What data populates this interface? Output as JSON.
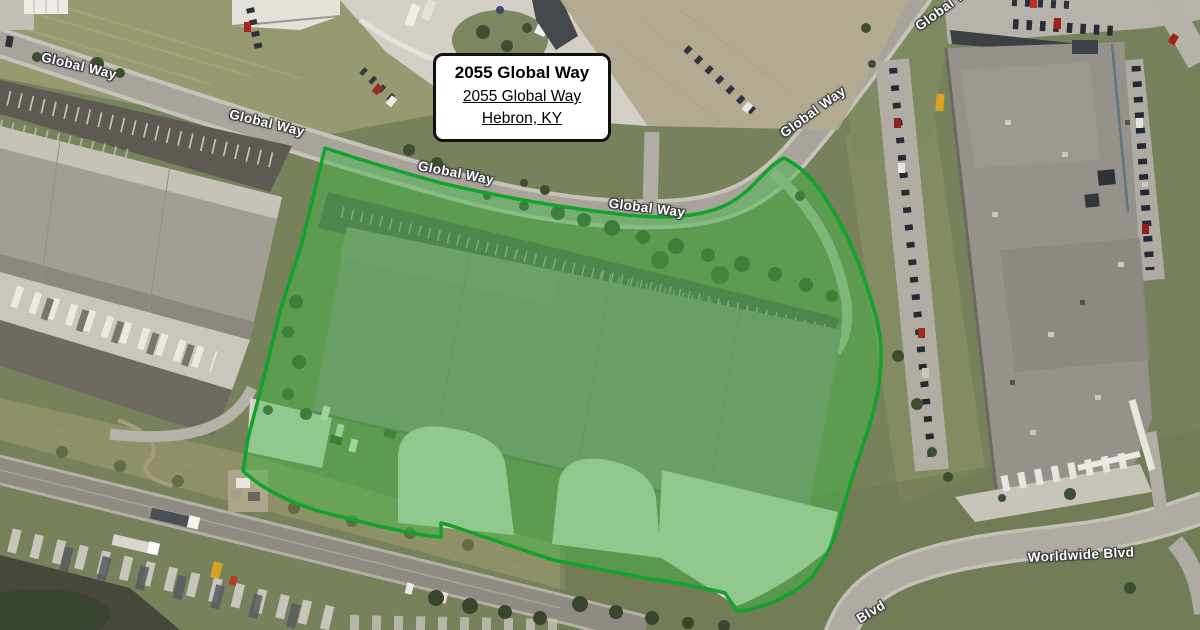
{
  "map_view": {
    "type": "satellite-imagery",
    "info_box": {
      "title": "2055 Global Way",
      "address_line1": "2055 Global Way",
      "address_line2": "Hebron, KY"
    },
    "road_labels": [
      {
        "id": "global-way-1",
        "text": "Global Way"
      },
      {
        "id": "global-way-2",
        "text": "Global Way"
      },
      {
        "id": "global-way-3",
        "text": "Global Way"
      },
      {
        "id": "global-way-4",
        "text": "Global Way"
      },
      {
        "id": "global-way-5",
        "text": "Global Way"
      },
      {
        "id": "global-way-6",
        "text": "Global Way"
      },
      {
        "id": "worldwide-blvd",
        "text": "Worldwide Blvd"
      },
      {
        "id": "blvd",
        "text": "Blvd"
      }
    ],
    "property_overlay": {
      "label": "2055 Global Way parcel highlight",
      "stroke_color": "#12a32c",
      "fill_color": "rgba(62,185,68,0.46)"
    }
  }
}
